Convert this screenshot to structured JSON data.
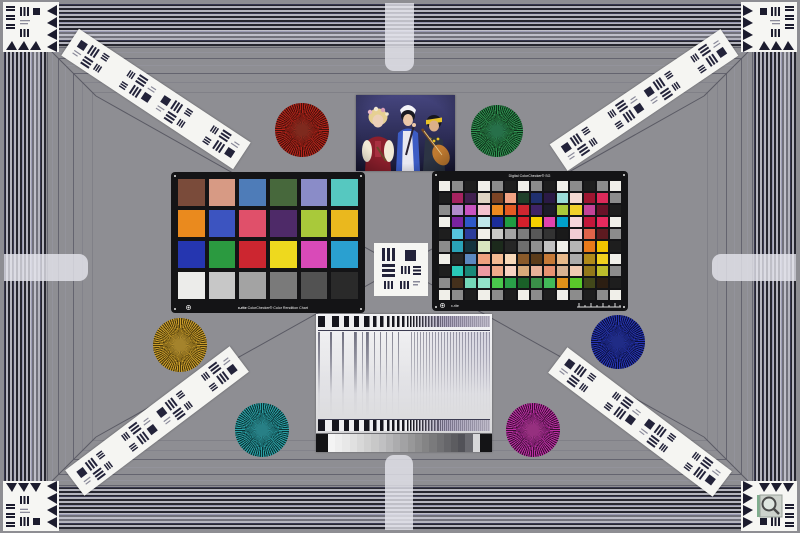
{
  "page": {
    "kind": "camera lens test chart",
    "style": "ISO-12233 style studio test scene"
  },
  "colors": {
    "background": "#8e8e93",
    "border_red": "#d22055",
    "border_dark": "#1c1c24",
    "diagonal_line": "#5a5a64",
    "panel_bg": "#ececee",
    "strip_white": "#f5f5f2"
  },
  "classic_checker": {
    "logo": "x-rite",
    "label": "ColorChecker® Color Rendition Chart",
    "cols": 6,
    "rows": 4,
    "patches": [
      "#7a4b3a",
      "#d79a84",
      "#4e7cb8",
      "#47683c",
      "#8a8cc8",
      "#56c8c0",
      "#ea8a1e",
      "#3c54c0",
      "#e0506a",
      "#4e2a68",
      "#a9c93a",
      "#eab81e",
      "#2536b0",
      "#2b9a40",
      "#cc2630",
      "#eed91e",
      "#d94ab8",
      "#2aa0d0",
      "#ececea",
      "#c7c7c7",
      "#a3a3a3",
      "#7a7a7a",
      "#525252",
      "#2a2a2a"
    ]
  },
  "sg_checker": {
    "title": "Digital ColorChecker® SG",
    "logo": "x-rite",
    "cols": 14,
    "rows": 10,
    "patches": [
      "#f0efe9",
      "#8c8c8c",
      "#1e1e1e",
      "#f0efe9",
      "#8c8c8c",
      "#1e1e1e",
      "#f0efe9",
      "#8c8c8c",
      "#1e1e1e",
      "#f0efe9",
      "#8c8c8c",
      "#1e1e1e",
      "#8c8c8c",
      "#f0efe9",
      "#1e1e1e",
      "#a62360",
      "#41204f",
      "#ded3c2",
      "#7c4425",
      "#f2a384",
      "#20402a",
      "#20306e",
      "#2a1a45",
      "#9adcd8",
      "#f4d9d2",
      "#9e1530",
      "#dd2a5a",
      "#8c8c8c",
      "#8c8c8c",
      "#b28ccc",
      "#c953c0",
      "#f3c2cd",
      "#ee8a20",
      "#e45b23",
      "#ce2630",
      "#3f2366",
      "#1c1c2a",
      "#a9c93a",
      "#f1d02a",
      "#c44398",
      "#691228",
      "#1e1e1e",
      "#f0efe9",
      "#7a23a0",
      "#2d58c8",
      "#bfe6ea",
      "#1c2d9a",
      "#209c42",
      "#d4202c",
      "#f5d000",
      "#e043ae",
      "#00a0ca",
      "#f5d5da",
      "#c2173a",
      "#e62a5e",
      "#f0efe9",
      "#1e1e1e",
      "#56c4dd",
      "#2b3c9b",
      "#f0efe9",
      "#c9c9c7",
      "#a3a3a3",
      "#7c7c7c",
      "#585858",
      "#333333",
      "#1a1a1a",
      "#f2ccd3",
      "#e0634a",
      "#5e1a20",
      "#8c8c8c",
      "#8c8c8c",
      "#2aa3b8",
      "#14333e",
      "#d9e6bf",
      "#1c2a1c",
      "#262626",
      "#6e6e6e",
      "#909090",
      "#c2c2c2",
      "#f0efe9",
      "#b5b5b5",
      "#e87a1a",
      "#f0c400",
      "#1e1e1e",
      "#f0efe9",
      "#262626",
      "#5c88c0",
      "#efa17e",
      "#f4ba92",
      "#f8d9ba",
      "#8a5a2a",
      "#5c3c1a",
      "#c67a38",
      "#e9ba8a",
      "#ababab",
      "#b08a1a",
      "#f0d01e",
      "#f0efe9",
      "#1e1e1e",
      "#2ac8b8",
      "#1a8878",
      "#ef9aa2",
      "#f0aa8a",
      "#f8d2c2",
      "#d8aa7a",
      "#e8b29a",
      "#e89272",
      "#d8b292",
      "#f0cab2",
      "#92781a",
      "#bcbc2c",
      "#8c8c8c",
      "#8c8c8c",
      "#44301c",
      "#74d8b8",
      "#92e2c8",
      "#4ac84c",
      "#2aa048",
      "#1a6028",
      "#3a9048",
      "#42ba58",
      "#e2921a",
      "#5ac82a",
      "#42481a",
      "#2c1e12",
      "#1e1e1e",
      "#f0efe9",
      "#8c8c8c",
      "#1e1e1e",
      "#f0efe9",
      "#8c8c8c",
      "#1e1e1e",
      "#f0efe9",
      "#8c8c8c",
      "#1e1e1e",
      "#f0efe9",
      "#8c8c8c",
      "#1e1e1e",
      "#8c8c8c",
      "#f0efe9"
    ]
  },
  "stars": [
    {
      "name": "red",
      "cx": 302,
      "cy": 130,
      "r": 27,
      "light": "#b3231a",
      "dark": "#44100a",
      "center": "#7e2a1e"
    },
    {
      "name": "green",
      "cx": 497,
      "cy": 131,
      "r": 26,
      "light": "#2f9150",
      "dark": "#0d2e18",
      "center": "#27704a"
    },
    {
      "name": "gold",
      "cx": 180,
      "cy": 345,
      "r": 27,
      "light": "#c99c2a",
      "dark": "#4a3a0c",
      "center": "#a4832c"
    },
    {
      "name": "teal",
      "cx": 262,
      "cy": 430,
      "r": 27,
      "light": "#2b9fa4",
      "dark": "#0a3234",
      "center": "#288086"
    },
    {
      "name": "blue",
      "cx": 618,
      "cy": 342,
      "r": 27,
      "light": "#2634b2",
      "dark": "#0a0f3a",
      "center": "#202c86"
    },
    {
      "name": "magenta",
      "cx": 533,
      "cy": 430,
      "r": 27,
      "light": "#bb2fa4",
      "dark": "#3c0e34",
      "center": "#96307f"
    }
  ],
  "strips": [
    {
      "pos": "top-left",
      "cx": 156,
      "cy": 99,
      "rot": 33.5
    },
    {
      "pos": "top-right",
      "cx": 644,
      "cy": 100,
      "rot": -34
    },
    {
      "pos": "bottom-left",
      "cx": 157,
      "cy": 421,
      "rot": -37
    },
    {
      "pos": "bottom-right",
      "cx": 640,
      "cy": 422,
      "rot": 37
    }
  ],
  "corner_targets": [
    {
      "pos": "top-left",
      "x": 3,
      "y": 2,
      "flip": "none",
      "magnifier": false
    },
    {
      "pos": "top-right",
      "x": 741,
      "y": 2,
      "flip": "x",
      "magnifier": false
    },
    {
      "pos": "bottom-left",
      "x": 3,
      "y": 481,
      "flip": "y",
      "magnifier": false
    },
    {
      "pos": "bottom-right",
      "x": 741,
      "y": 481,
      "flip": "xy",
      "magnifier": true
    }
  ],
  "tabs": [
    {
      "pos": "top",
      "x": 385,
      "y": 3,
      "w": 29,
      "h": 68,
      "round": "bottom"
    },
    {
      "pos": "bottom",
      "x": 385,
      "y": 455,
      "w": 28,
      "h": 75,
      "round": "top"
    },
    {
      "pos": "left",
      "x": 4,
      "y": 254,
      "w": 84,
      "h": 27,
      "round": "right"
    },
    {
      "pos": "right",
      "x": 712,
      "y": 254,
      "w": 84,
      "h": 27,
      "round": "left"
    }
  ],
  "wedge": {
    "cap_color": "#141416",
    "steps": [
      "#f4f4f4",
      "#eeeeee",
      "#e8e8e8",
      "#e0e0e0",
      "#d8d8d8",
      "#d0d0d0",
      "#c8c8c8",
      "#c0c0c2",
      "#b6b6b8",
      "#acacae",
      "#a2a2a4",
      "#989899",
      "#8e8e8f",
      "#848485",
      "#7a7a7c",
      "#707073",
      "#66666a",
      "#5c5c60",
      "#525258",
      "#6a6a70",
      "#d8d8da"
    ]
  },
  "panel": {
    "chirp": [
      {
        "w": 15,
        "p": 14
      },
      {
        "w": 13,
        "p": 10
      },
      {
        "w": 12,
        "p": 7
      },
      {
        "w": 12,
        "p": 5
      },
      {
        "w": 18,
        "p": 3
      },
      {
        "w": 30,
        "p": 2
      }
    ]
  },
  "photo": {
    "subject": "Three costumed musicians with flutes and a lute"
  }
}
